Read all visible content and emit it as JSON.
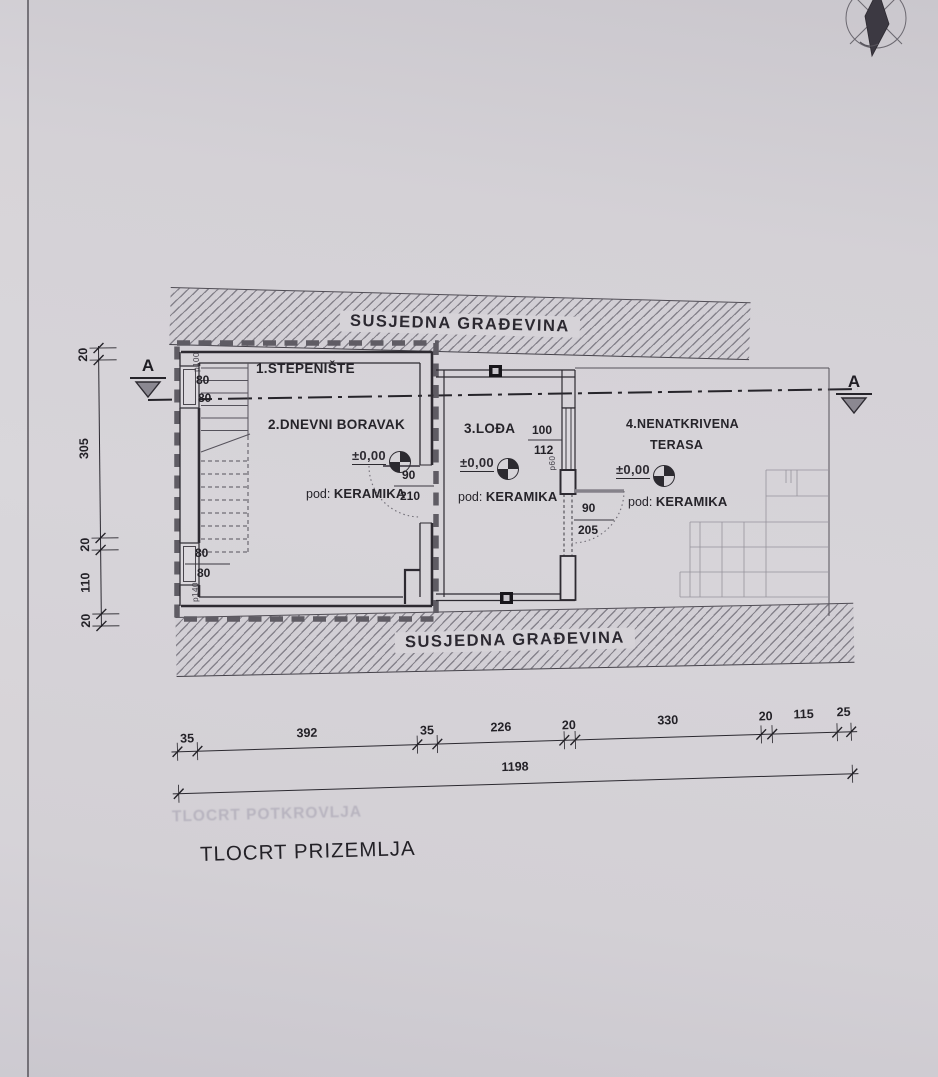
{
  "drawing": {
    "title": "TLOCRT PRIZEMLJA",
    "ghost_title": "TLOCRT POTKROVLJA",
    "neighbor_label_top": "SUSJEDNA GRAĐEVINA",
    "neighbor_label_bottom": "SUSJEDNA GRAĐEVINA",
    "section_label_left": "A",
    "section_label_right": "A",
    "rooms": {
      "stepeniste": {
        "name": "1.STEPENIŠTE"
      },
      "dnevni": {
        "name": "2.DNEVNI BORAVAK",
        "level": "±0,00",
        "floor_prefix": "pod:",
        "floor": "KERAMIKA"
      },
      "lodja": {
        "name": "3.LOĐA",
        "level": "±0,00",
        "floor_prefix": "pod:",
        "floor": "KERAMIKA"
      },
      "terasa": {
        "name": "4.NENATKRIVENA",
        "name2": "TERASA",
        "level": "±0,00",
        "floor_prefix": "pod:",
        "floor": "KERAMIKA"
      }
    },
    "openings": {
      "window_left_top": {
        "width": "80",
        "height": "80",
        "parapet": "p100"
      },
      "window_left_bottom": {
        "width": "80",
        "height": "80",
        "parapet": "p140"
      },
      "door_dnevni": {
        "width": "90",
        "height": "210"
      },
      "window_lodja": {
        "width": "100",
        "height": "112",
        "parapet": "p60"
      },
      "door_lodja": {
        "width": "90",
        "height": "205"
      }
    },
    "dimensions": {
      "horizontal": [
        "35",
        "392",
        "35",
        "226",
        "20",
        "330",
        "20",
        "115",
        "25"
      ],
      "horizontal_total": "1198",
      "vertical": [
        "20",
        "305",
        "20",
        "110",
        "20"
      ]
    }
  }
}
